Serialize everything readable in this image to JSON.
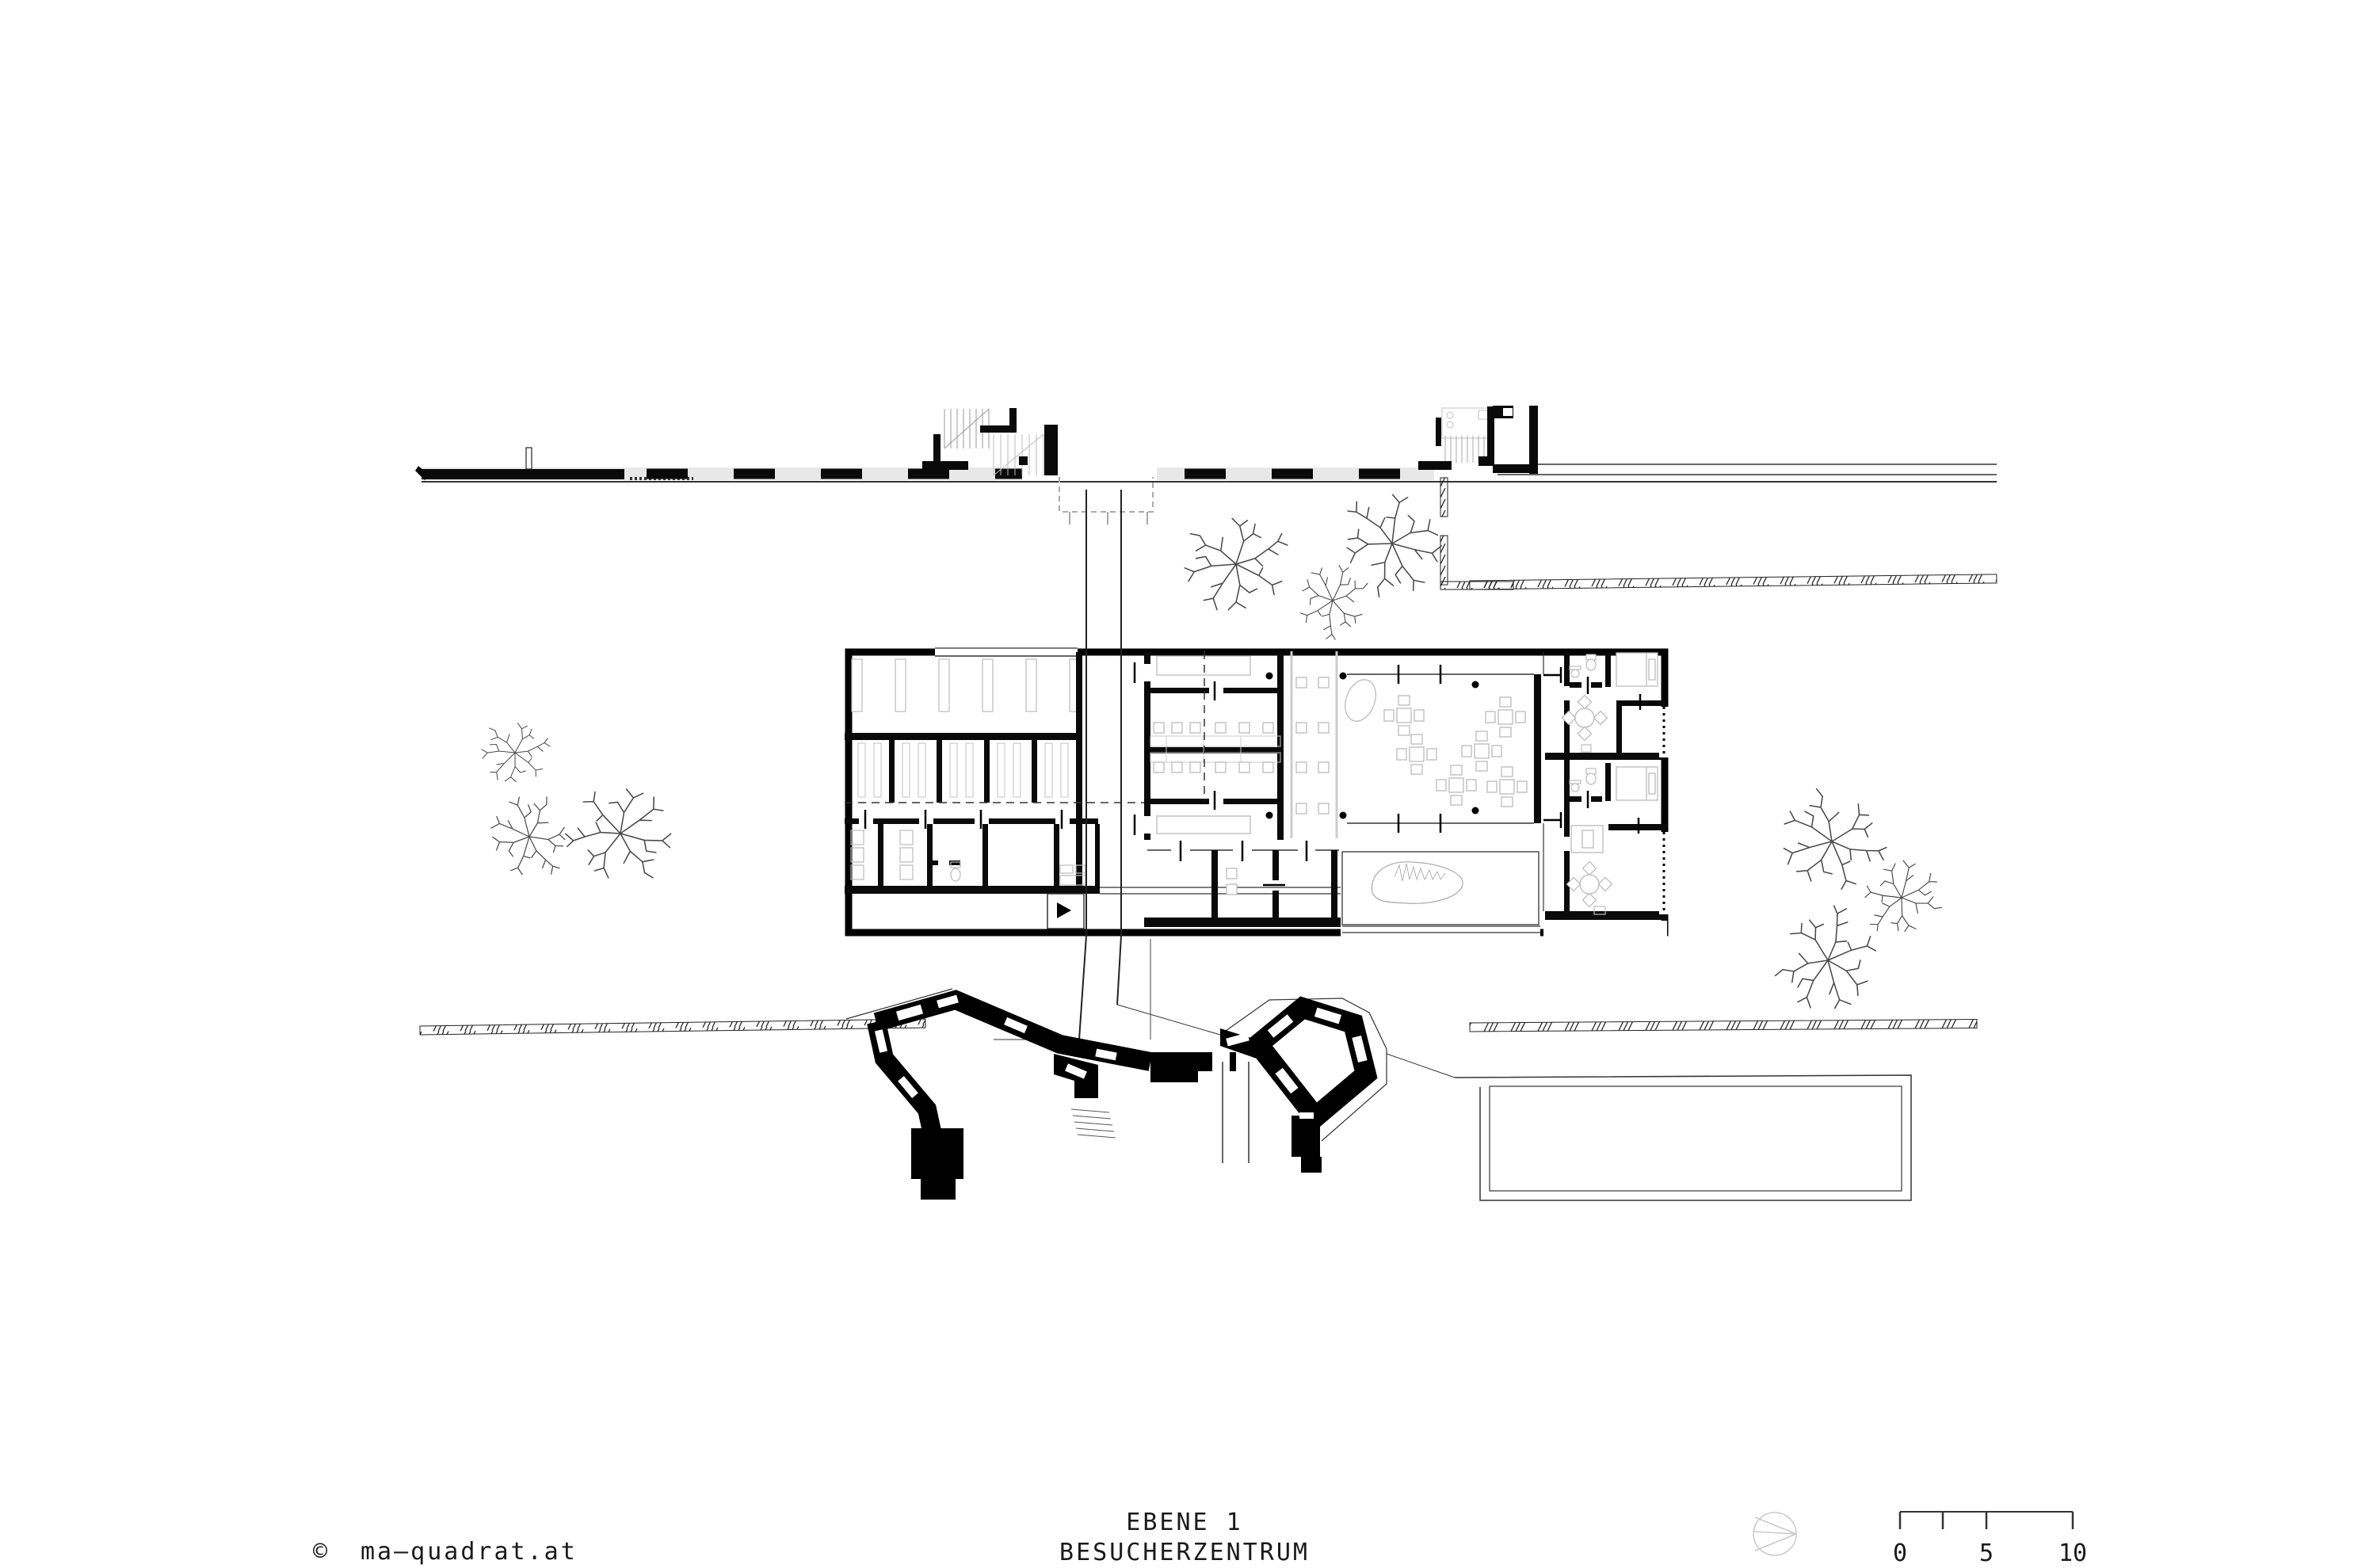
{
  "document": {
    "type": "architectural-floor-plan",
    "background": "#ffffff"
  },
  "footer": {
    "copyright_symbol": "©",
    "copyright_text": "ma—quadrat.at",
    "title_line1": "EBENE 1",
    "title_line2": "BESUCHERZENTRUM"
  },
  "scale_bar": {
    "labels": {
      "start": "0",
      "mid": "5",
      "end": "10"
    }
  },
  "icons": {
    "north_indicator": "north-indicator-icon",
    "entrance_arrow": "entrance-arrow-icon"
  },
  "colors": {
    "ink": "#000000",
    "wall_black": "#0a0a0a",
    "furniture_gray": "#bbbbbb",
    "site_gray": "#888888",
    "band_gray": "#e8e8e8"
  }
}
